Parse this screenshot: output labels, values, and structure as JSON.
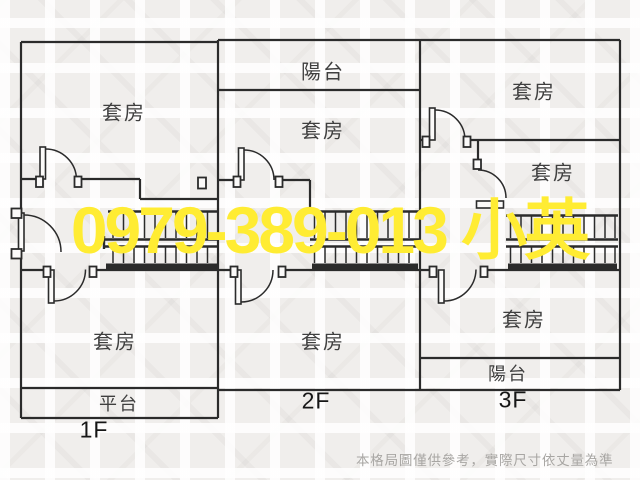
{
  "watermark": {
    "text": "0979-389-013 小英",
    "color": "#ffec33"
  },
  "disclaimer": {
    "text": "本格局圖僅供參考，實際尺寸依丈量為準",
    "color": "#a8a6a3"
  },
  "palette": {
    "background": "#f0eeec",
    "wall_line": "#2b2b2b",
    "label_text": "#3f3f3f"
  },
  "units": [
    {
      "floor_label": "1F",
      "rooms": {
        "upper": "套房",
        "lower": "套房",
        "strip": "平台"
      }
    },
    {
      "floor_label": "2F",
      "rooms": {
        "strip": "陽台",
        "upper": "套房",
        "lower": "套房"
      }
    },
    {
      "floor_label": "3F",
      "rooms": {
        "upper": "套房",
        "middle": "套房",
        "lower": "套房",
        "strip": "陽台"
      }
    }
  ]
}
